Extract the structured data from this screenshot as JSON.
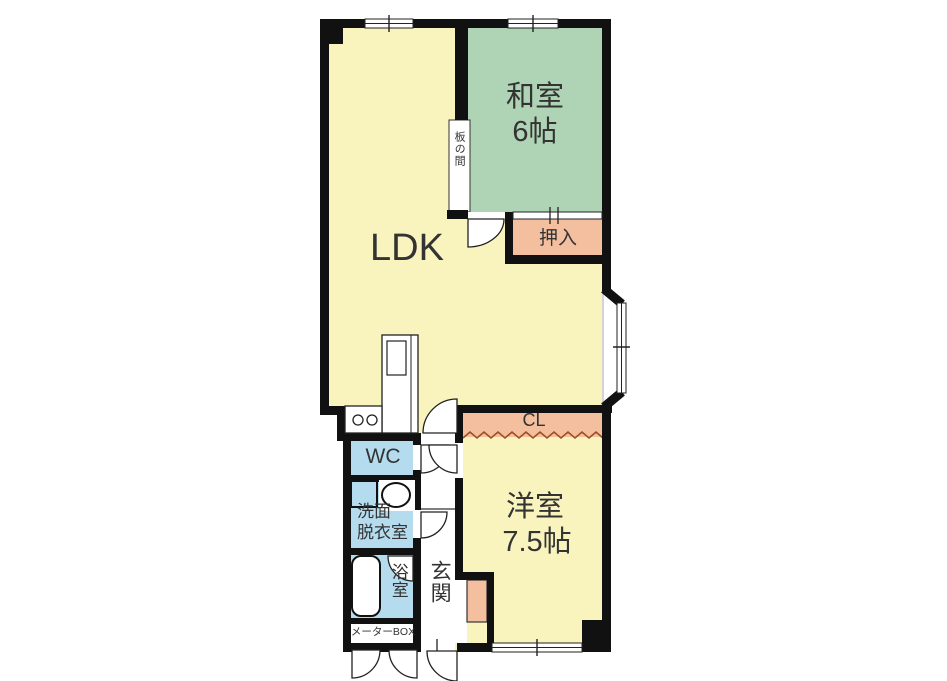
{
  "floorplan": {
    "title": "apartment-floor-plan",
    "rooms": {
      "ldk": {
        "label": "LDK",
        "color": "#f9f3bd"
      },
      "washitsu": {
        "name": "和室",
        "size": "6帖",
        "color": "#afd3b5"
      },
      "oshiire": {
        "label": "押入",
        "color": "#f3bf9f"
      },
      "itanoma": {
        "label": "板の間",
        "color": "#ffffff"
      },
      "closet": {
        "label": "CL",
        "color": "#f3bf9f"
      },
      "youshitsu": {
        "name": "洋室",
        "size": "7.5帖",
        "color": "#f9f3bd"
      },
      "wc": {
        "label": "WC",
        "color": "#b5dcee"
      },
      "senmen": {
        "line1": "洗面",
        "line2": "脱衣室",
        "color": "#b5dcee"
      },
      "yokushitsu": {
        "label": "浴室",
        "color": "#b5dcee"
      },
      "genkan": {
        "label": "玄関",
        "color": "#ffffff"
      },
      "meter_box": {
        "label": "メーターBOX",
        "color": "#ffffff"
      }
    },
    "colors": {
      "wall": "#111111",
      "floor_yellow": "#f9f3bd",
      "tatami_green": "#afd3b5",
      "closet_salmon": "#f3bf9f",
      "water_blue": "#b5dcee",
      "zigzag_brown": "#9c4f22",
      "text": "#333333",
      "background": "#ffffff"
    }
  }
}
